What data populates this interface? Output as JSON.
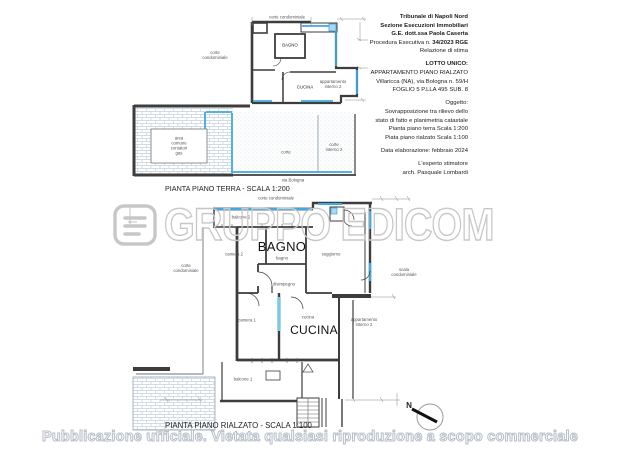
{
  "header": {
    "court_line1": "Tribunale di Napoli Nord",
    "court_line2": "Sezione Esecuzioni Immobiliari",
    "court_line3": "G.E. dott.ssa Paola Caserta",
    "procedure_prefix": "Procedura Esecutiva n. ",
    "procedure_number": "34/2023 RGE",
    "report_type": "Relazione di stima",
    "lot_title": "LOTTO UNICO:",
    "lot_line1": "APPARTAMENTO PIANO RIALZATO",
    "lot_line2": "Villaricca (NA), via Bologna n. 59/H",
    "lot_line3": "FOGLIO 5 P.LLA 495 SUB. 8",
    "object_title": "Oggetto:",
    "object_line1": "Sovrapposizione tra rilievo dello",
    "object_line2": "stato di fatto e planimetria catastale",
    "object_line3": "Pianta piano terra  Scala 1:200",
    "object_line4": "Piata piano rialzato Scala 1:100",
    "date_line": "Data elaborazione: febbraio 2024",
    "expert_line1": "L'esperto stimatore",
    "expert_line2": "arch.  Pasquale Lombardi"
  },
  "plan_terra": {
    "caption": "PIANTA PIANO TERRA - SCALA 1:200",
    "labels": {
      "corte_condominiale_top": "corte condominiale",
      "corte_condominiale_left_1": "corte",
      "corte_condominiale_left_2": "condominiale",
      "bagno": "BAGNO",
      "cucina": "CUCINA",
      "appartamento_1": "appartamento",
      "appartamento_2": "interno 2",
      "area_comune_1": "area",
      "area_comune_2": "comune",
      "area_comune_3": "contatori",
      "area_comune_4": "gas",
      "corte": "corte",
      "corte_interno_1": "corte",
      "corte_interno_2": "interno 2",
      "via_bologna": "via Bologna"
    }
  },
  "plan_rialzato": {
    "caption": "PIANTA PIANO RIALZATO - SCALA 1:100",
    "labels": {
      "corte_condominiale_top": "corte condominiale",
      "balcone2": "balcone 2",
      "camera2": "camera 2",
      "bagno_big": "BAGNO",
      "bagno_small": "bagno",
      "soggiorno": "soggiorno",
      "corte_condominiale_left_1": "corte",
      "corte_condominiale_left_2": "condominiale",
      "scala_1": "scala",
      "scala_2": "condominiale",
      "disimpegno": "disimpegno",
      "camera1": "camera 1",
      "cucina_small": "cucina",
      "cucina_big": "CUCINA",
      "appartamento_1": "appartamento",
      "appartamento_2": "interno 2",
      "balcone1": "balcone 1"
    }
  },
  "watermark": {
    "text": "GRUPPO EDICOM"
  },
  "compass": {
    "north": "N"
  },
  "footer": {
    "text": "Pubblicazione ufficiale. Vietata qualsiasi riproduzione a scopo commerciale"
  },
  "colors": {
    "wall": "#3d3d3d",
    "overlay_blue": "#3fa9e0",
    "overlay_blue_fill": "#a9d7f0",
    "hatch_line": "#c6d1da",
    "watermark_gray": "#c7c7c7"
  }
}
